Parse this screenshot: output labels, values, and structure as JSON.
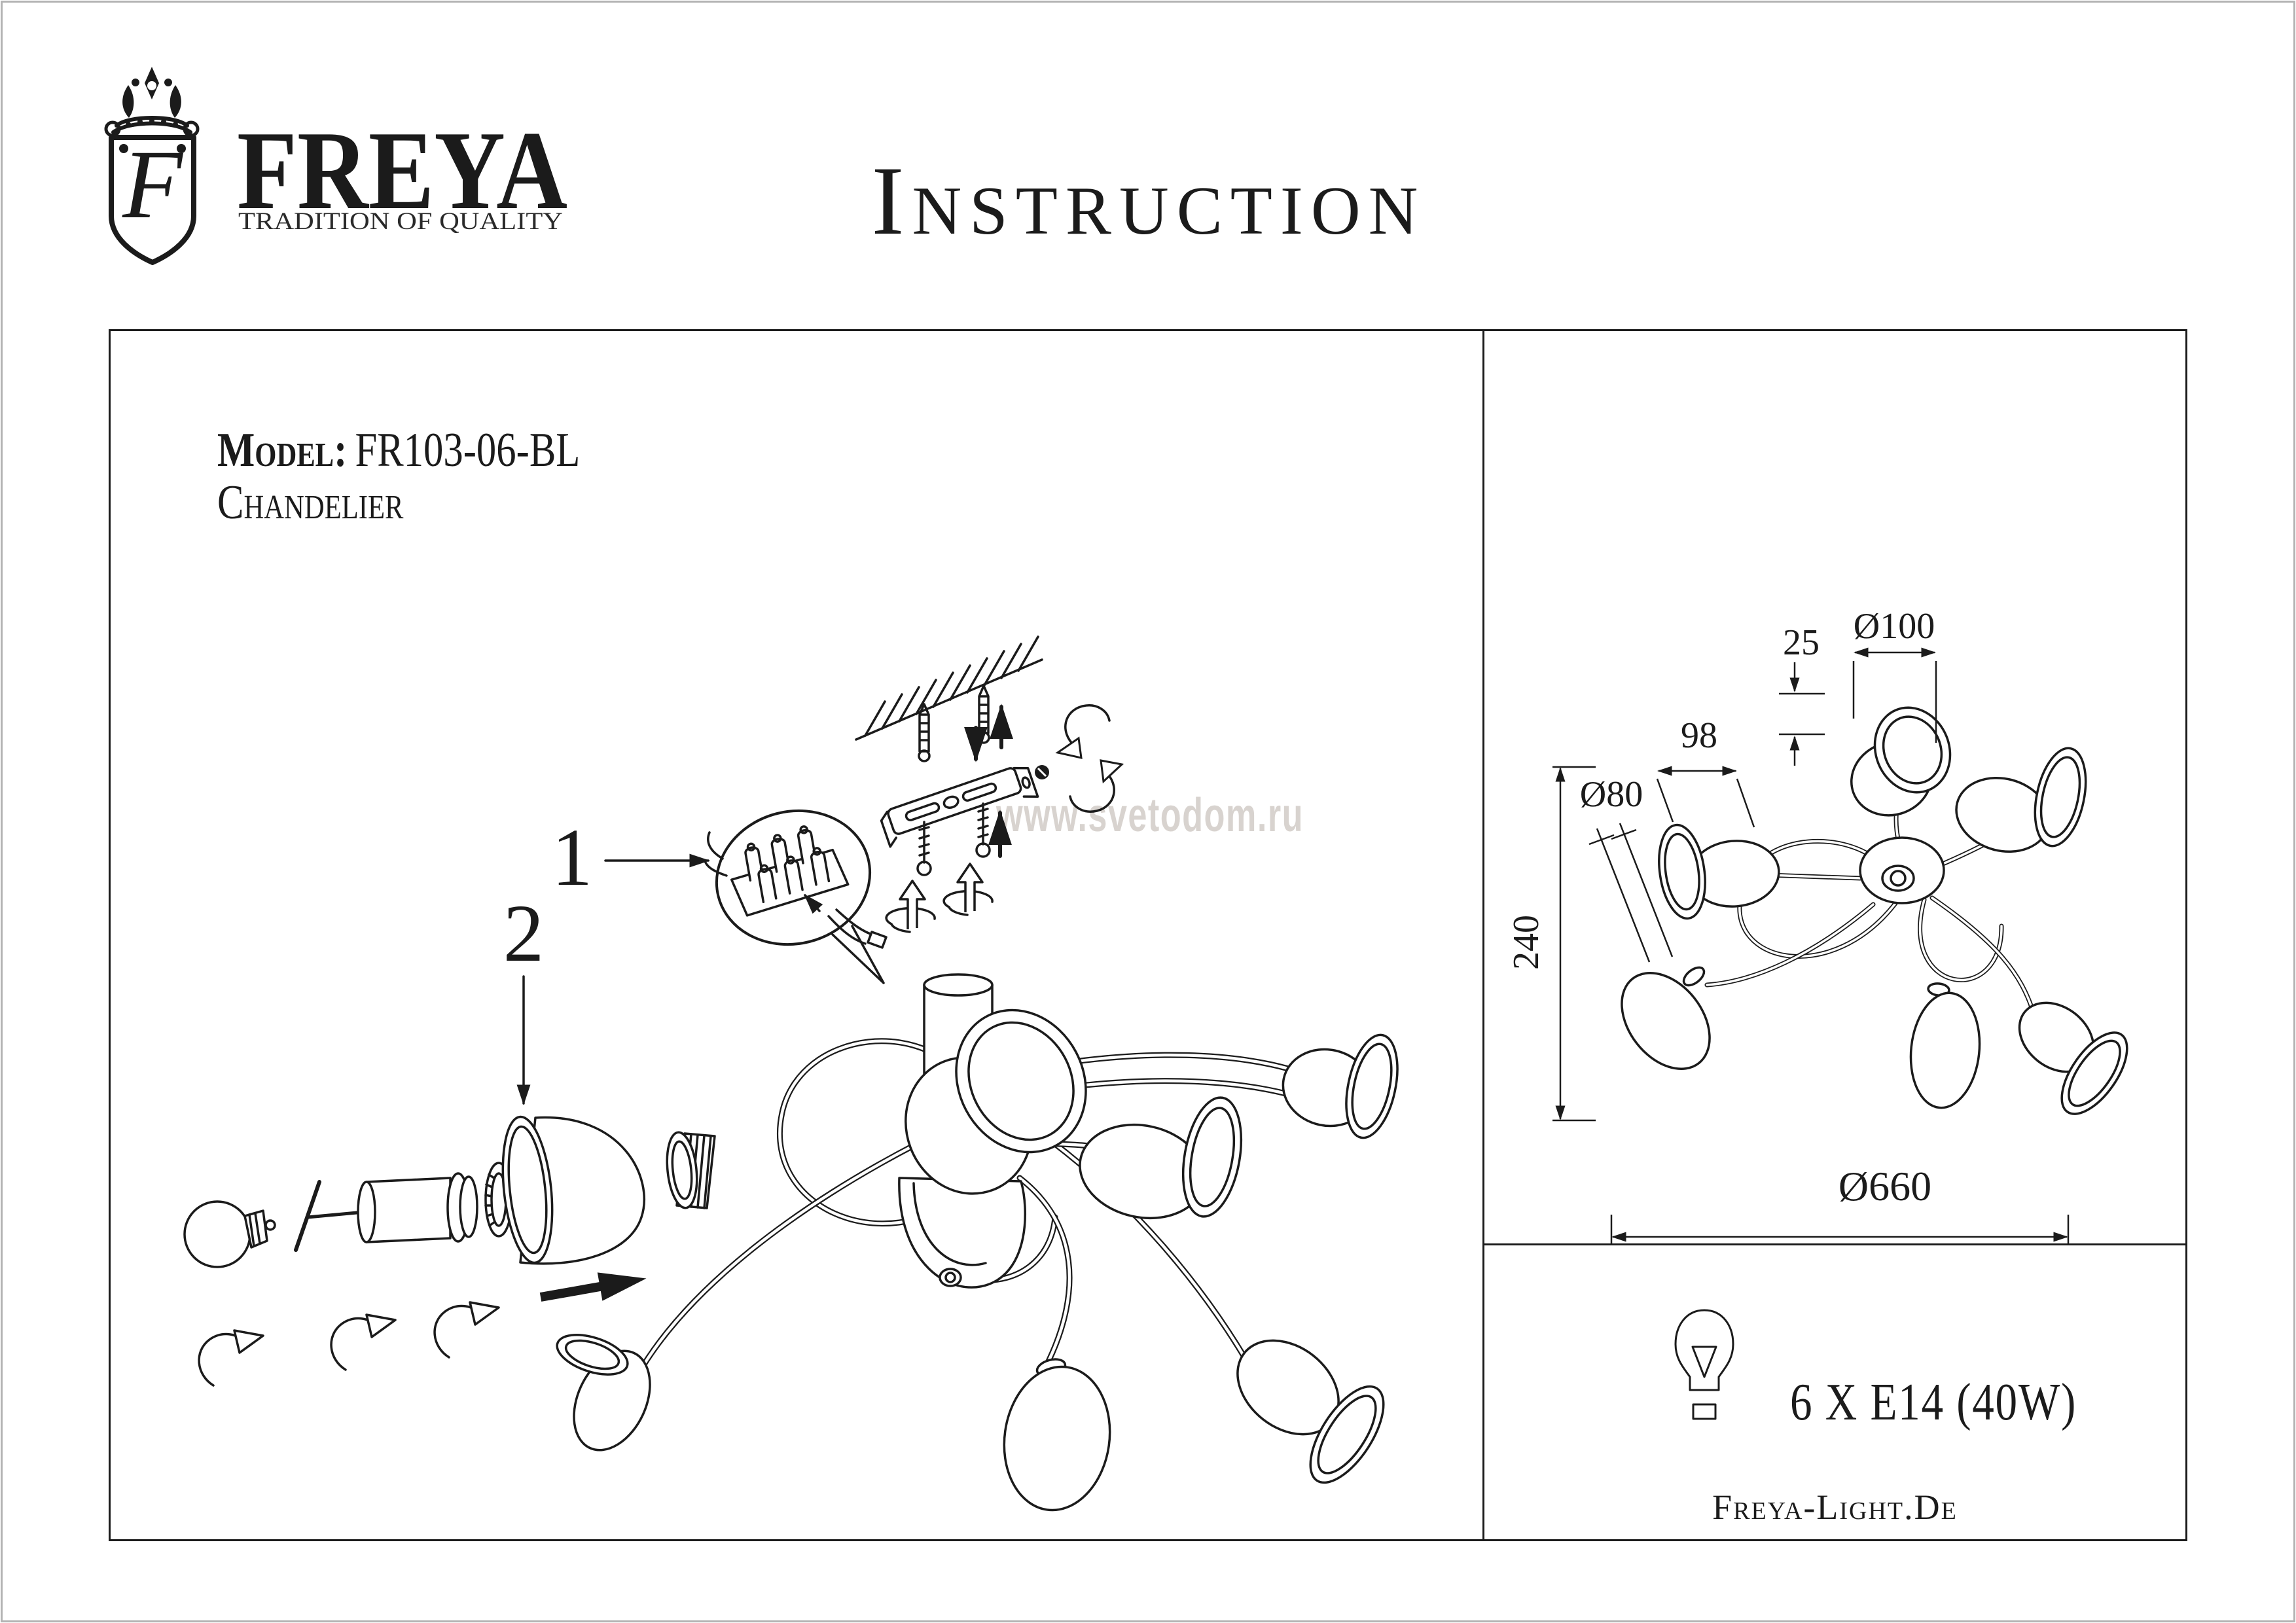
{
  "brand": {
    "monogram": "F",
    "name": "FREYA",
    "tagline": "TRADITION OF QUALITY"
  },
  "title": "Instruction",
  "product": {
    "model_label": "Model:",
    "model": "FR103-06-BL",
    "type": "Chandelier"
  },
  "steps": {
    "step1": "1",
    "step2": "2"
  },
  "watermark": "www.svetodom.ru",
  "dimensions": {
    "top_shade": "Ø100",
    "canopy_offset": "25",
    "arm": "98",
    "side_shade": "Ø80",
    "height": "240",
    "overall": "Ø660"
  },
  "spec": {
    "lamps": "6 X E14 (40W)"
  },
  "footer": {
    "website": "Freya-Light.De"
  },
  "colors": {
    "line": "#1b1b1b",
    "watermark": "#d8d3cf",
    "frame": "#b3b3b3"
  }
}
